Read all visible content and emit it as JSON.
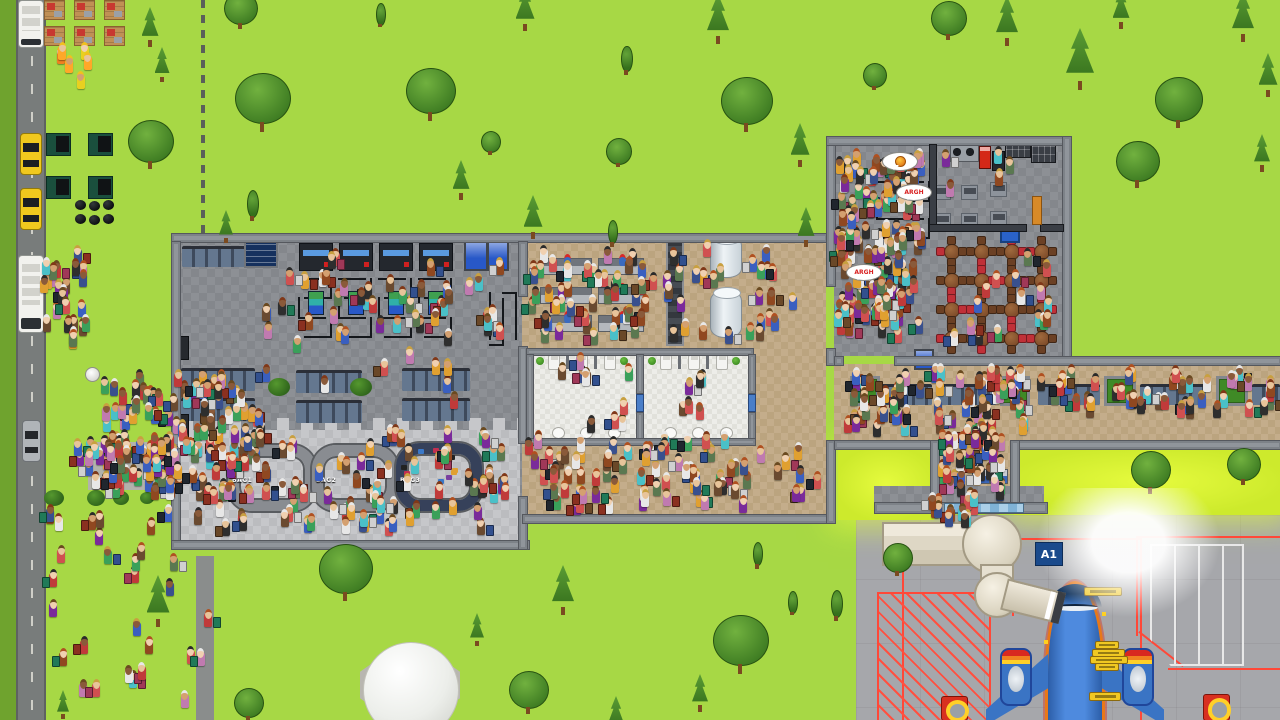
{
  "viewport": {
    "width": 1280,
    "height": 720
  },
  "labels": {
    "gate_sign": "A1",
    "carousels": [
      "BAG1",
      "BAG2",
      "BAG3"
    ],
    "speech_bubbles": [
      {
        "kind": "food-icon",
        "text": ""
      },
      {
        "kind": "text",
        "text": "ARGH"
      },
      {
        "kind": "text",
        "text": "ARGH"
      }
    ]
  },
  "palette": {
    "grass": "#a7d845",
    "grass_dark": "#6fa32e",
    "grass_lit": "#cdea2c",
    "road": "#787c7b",
    "tarmac": "#a6a7ab",
    "floor_dark": "#8d9095",
    "floor_light": "#c6c7ca",
    "floor_tan": "#c4ad8b",
    "floor_tile": "#ededE9",
    "wall": "#90959b",
    "carousel_gray": "#898c91",
    "carousel_navy": "#36415a",
    "plane_blue": "#4e8ade",
    "plane_trim_orange": "#e87818",
    "plane_trim_red": "#d83020",
    "gate_sign_bg": "#1a4a8c",
    "marking_red": "#ff4838",
    "jetbridge": "#e6e0d0",
    "taxi_yellow": "#f0c81e",
    "bubble_text_red": "#d82020"
  },
  "scene": {
    "floors": [
      [
        "grass-dark",
        0,
        0,
        16,
        720
      ],
      [
        "road",
        16,
        0,
        26,
        720
      ],
      [
        "service-road",
        196,
        556,
        18,
        164
      ],
      [
        "fence",
        201,
        0,
        4,
        237
      ],
      [
        "sidewalk",
        88,
        442,
        90,
        48
      ],
      [
        "tarmac",
        856,
        515,
        424,
        205
      ],
      [
        "bright",
        838,
        448,
        96,
        72
      ],
      [
        "bright",
        1014,
        448,
        266,
        67
      ],
      [
        "floor-dark",
        175,
        237,
        347,
        311
      ],
      [
        "floor-light",
        181,
        430,
        339,
        112
      ],
      [
        "scallop",
        181,
        418,
        339,
        12
      ],
      [
        "floor-tan",
        522,
        237,
        304,
        285
      ],
      [
        "floor-dark",
        834,
        144,
        228,
        212
      ],
      [
        "floor-tan",
        834,
        364,
        446,
        82
      ],
      [
        "floor-tan",
        938,
        446,
        72,
        60
      ],
      [
        "floor-dark",
        874,
        486,
        170,
        18
      ],
      [
        "floor-tile",
        530,
        354,
        106,
        84
      ],
      [
        "floor-tile",
        642,
        354,
        106,
        84
      ]
    ],
    "walls": [
      [
        171,
        233,
        655,
        8
      ],
      [
        171,
        241,
        8,
        204
      ],
      [
        171,
        478,
        8,
        70
      ],
      [
        171,
        540,
        357,
        8
      ],
      [
        518,
        241,
        8,
        54
      ],
      [
        518,
        346,
        8,
        96
      ],
      [
        518,
        496,
        8,
        52
      ],
      [
        522,
        514,
        312,
        8
      ],
      [
        826,
        440,
        8,
        82
      ],
      [
        826,
        136,
        8,
        149
      ],
      [
        826,
        348,
        8,
        16
      ],
      [
        826,
        136,
        244,
        8
      ],
      [
        1062,
        136,
        8,
        228
      ],
      [
        834,
        356,
        8,
        8
      ],
      [
        894,
        356,
        386,
        8
      ],
      [
        834,
        440,
        104,
        8
      ],
      [
        1010,
        440,
        270,
        8
      ],
      [
        930,
        440,
        8,
        66
      ],
      [
        1010,
        440,
        8,
        66
      ],
      [
        874,
        502,
        172,
        10
      ],
      [
        526,
        348,
        226,
        6
      ],
      [
        526,
        354,
        6,
        90
      ],
      [
        636,
        354,
        6,
        38
      ],
      [
        636,
        412,
        6,
        30
      ],
      [
        748,
        354,
        6,
        38
      ],
      [
        748,
        412,
        6,
        30
      ],
      [
        526,
        438,
        228,
        6
      ]
    ],
    "dark_walls": [
      [
        929,
        144,
        6,
        84
      ],
      [
        929,
        224,
        96,
        6
      ],
      [
        1040,
        224,
        22,
        6
      ]
    ],
    "glass_panels": [
      [
        944,
        503,
        78,
        8
      ]
    ],
    "security": {
      "lane_x": [
        298,
        338,
        378,
        418
      ],
      "scanner_y": 243,
      "queue_y": 268,
      "queue_h": 78
    },
    "extra_queues": {
      "exit_v": [
        482,
        292,
        40,
        54,
        3
      ],
      "foodcourt": [
        876,
        172,
        54,
        74,
        4
      ]
    },
    "bathrooms": {
      "room_x": [
        532,
        644
      ],
      "toilet_y": 355,
      "sink_y": 427
    },
    "diner_tables": {
      "x0": 938,
      "y0": 238,
      "cols": 4,
      "rows": 4,
      "dx": 30,
      "dy": 29
    },
    "furniture": [
      [
        "bench",
        182,
        246,
        64,
        18
      ],
      [
        "infoboard",
        244,
        236,
        30,
        28
      ],
      [
        "bench",
        181,
        368,
        74,
        20
      ],
      [
        "bench",
        296,
        370,
        66,
        20
      ],
      [
        "bench",
        402,
        368,
        68,
        20
      ],
      [
        "bench",
        181,
        398,
        74,
        20
      ],
      [
        "bench",
        296,
        400,
        66,
        20
      ],
      [
        "bench",
        402,
        398,
        68,
        20
      ],
      [
        "fridge",
        177,
        336,
        10,
        22
      ],
      [
        "fridge",
        177,
        414,
        10,
        22
      ],
      [
        "vendingblue",
        464,
        240,
        20,
        27
      ],
      [
        "vendingblue",
        487,
        240,
        18,
        27
      ],
      [
        "desk",
        540,
        258,
        50,
        15
      ],
      [
        "desk",
        598,
        258,
        44,
        15
      ],
      [
        "desk",
        540,
        287,
        50,
        15
      ],
      [
        "desk",
        598,
        287,
        44,
        15
      ],
      [
        "desk",
        540,
        315,
        50,
        15
      ],
      [
        "desk",
        598,
        315,
        44,
        15
      ],
      [
        "conveyor",
        666,
        238,
        14,
        104
      ],
      [
        "cylinder",
        710,
        236,
        30,
        40
      ],
      [
        "cylinder",
        710,
        290,
        30,
        46
      ],
      [
        "stove",
        950,
        143,
        27,
        17
      ],
      [
        "vendingred",
        979,
        146,
        10,
        21
      ],
      [
        "fridge",
        992,
        151,
        11,
        18
      ],
      [
        "counterdark",
        1005,
        140,
        24,
        16
      ],
      [
        "counterdark",
        1031,
        145,
        23,
        16
      ],
      [
        "preptable",
        934,
        185,
        15,
        13
      ],
      [
        "preptable",
        961,
        185,
        15,
        13
      ],
      [
        "preptable",
        990,
        182,
        15,
        13
      ],
      [
        "preptable",
        934,
        213,
        15,
        13
      ],
      [
        "preptable",
        961,
        213,
        15,
        13
      ],
      [
        "preptable",
        990,
        211,
        15,
        13
      ],
      [
        "crate",
        1000,
        224,
        16,
        15
      ],
      [
        "dooror",
        1032,
        196,
        8,
        27
      ],
      [
        "doorblue",
        636,
        394,
        6,
        16
      ],
      [
        "doorblue",
        748,
        394,
        6,
        16
      ],
      [
        "gatedesk",
        972,
        469,
        16,
        13
      ],
      [
        "gatedesk",
        990,
        469,
        16,
        13
      ],
      [
        "vendingblue",
        914,
        349,
        16,
        17
      ],
      [
        "planter",
        850,
        376,
        24,
        24
      ],
      [
        "bench",
        876,
        384,
        56,
        18
      ],
      [
        "bench",
        938,
        384,
        58,
        18
      ],
      [
        "planter",
        1000,
        376,
        24,
        24
      ],
      [
        "bench",
        1038,
        384,
        62,
        18
      ],
      [
        "planter",
        1104,
        376,
        26,
        24
      ],
      [
        "bench",
        1140,
        384,
        66,
        18
      ],
      [
        "planter",
        1216,
        376,
        26,
        24
      ],
      [
        "bench",
        1252,
        384,
        28,
        18
      ],
      [
        "tag",
        1084,
        587,
        36,
        7
      ],
      [
        "tag",
        1095,
        641,
        22,
        6
      ],
      [
        "tag",
        1092,
        649,
        31,
        6
      ],
      [
        "tag",
        1090,
        656,
        36,
        6
      ],
      [
        "tag",
        1095,
        663,
        22,
        6
      ],
      [
        "tag",
        1089,
        692,
        30,
        7
      ],
      [
        "fuelpit",
        941,
        696,
        25,
        23
      ],
      [
        "fuelpit",
        1203,
        694,
        25,
        25
      ],
      [
        "pallet",
        44,
        0,
        19,
        18
      ],
      [
        "pallet",
        74,
        0,
        19,
        18
      ],
      [
        "pallet",
        104,
        0,
        19,
        18
      ],
      [
        "pallet",
        44,
        26,
        19,
        18
      ],
      [
        "pallet",
        74,
        26,
        19,
        18
      ],
      [
        "pallet",
        104,
        26,
        19,
        18
      ],
      [
        "dumpster",
        46,
        133,
        23,
        21
      ],
      [
        "dumpster",
        88,
        133,
        23,
        21
      ],
      [
        "dumpster",
        46,
        176,
        23,
        21
      ],
      [
        "dumpster",
        88,
        176,
        23,
        21
      ],
      [
        "trashbag",
        75,
        200,
        11,
        10
      ],
      [
        "trashbag",
        89,
        201,
        11,
        10
      ],
      [
        "trashbag",
        103,
        200,
        11,
        10
      ],
      [
        "trashbag",
        75,
        214,
        11,
        10
      ],
      [
        "trashbag",
        89,
        215,
        11,
        10
      ],
      [
        "trashbag",
        103,
        214,
        11,
        10
      ],
      [
        "hedge",
        97,
        447,
        44,
        11
      ],
      [
        "hedge",
        152,
        447,
        16,
        11
      ],
      [
        "bush",
        44,
        490,
        20,
        16
      ],
      [
        "bush",
        87,
        490,
        18,
        16
      ],
      [
        "bush",
        113,
        491,
        16,
        14
      ],
      [
        "bush",
        140,
        492,
        14,
        12
      ],
      [
        "bush",
        268,
        378,
        22,
        18
      ],
      [
        "bush",
        350,
        378,
        22,
        18
      ],
      [
        "bus",
        18,
        0,
        24,
        46
      ],
      [
        "taxi",
        20,
        133,
        20,
        40
      ],
      [
        "taxi",
        20,
        188,
        20,
        40
      ],
      [
        "bus",
        18,
        255,
        24,
        76
      ],
      [
        "car",
        22,
        420,
        17,
        40
      ],
      [
        "lamp",
        85,
        367,
        13,
        13
      ]
    ],
    "trees": [
      [
        262,
        100,
        "R",
        54
      ],
      [
        430,
        92,
        "R",
        48
      ],
      [
        618,
        150,
        "R",
        24
      ],
      [
        746,
        102,
        "R",
        50
      ],
      [
        874,
        74,
        "R",
        22
      ],
      [
        948,
        18,
        "R",
        34
      ],
      [
        718,
        16,
        "C",
        44
      ],
      [
        626,
        57,
        "Y",
        22
      ],
      [
        525,
        6,
        "C",
        38
      ],
      [
        461,
        177,
        "C",
        34
      ],
      [
        490,
        140,
        "R",
        18
      ],
      [
        533,
        214,
        "C",
        38
      ],
      [
        1007,
        18,
        "C",
        44
      ],
      [
        1080,
        56,
        "C",
        56
      ],
      [
        1121,
        6,
        "C",
        34
      ],
      [
        1178,
        100,
        "R",
        46
      ],
      [
        1243,
        14,
        "C",
        44
      ],
      [
        1268,
        72,
        "C",
        38
      ],
      [
        1137,
        162,
        "R",
        42
      ],
      [
        612,
        230,
        "Y",
        20
      ],
      [
        150,
        24,
        "C",
        34
      ],
      [
        162,
        62,
        "C",
        30
      ],
      [
        150,
        142,
        "R",
        44
      ],
      [
        240,
        8,
        "R",
        32
      ],
      [
        252,
        202,
        "Y",
        24
      ],
      [
        226,
        224,
        "C",
        28
      ],
      [
        800,
        142,
        "C",
        38
      ],
      [
        806,
        224,
        "C",
        34
      ],
      [
        1262,
        150,
        "C",
        32
      ],
      [
        380,
        12,
        "Y",
        18
      ],
      [
        345,
        570,
        "R",
        52
      ],
      [
        563,
        587,
        "C",
        44
      ],
      [
        477,
        627,
        "C",
        28
      ],
      [
        528,
        690,
        "R",
        38
      ],
      [
        616,
        712,
        "C",
        32
      ],
      [
        740,
        642,
        "R",
        54
      ],
      [
        700,
        690,
        "C",
        32
      ],
      [
        836,
        602,
        "Y",
        24
      ],
      [
        757,
        552,
        "Y",
        20
      ],
      [
        792,
        600,
        "Y",
        18
      ],
      [
        158,
        598,
        "C",
        46
      ],
      [
        248,
        702,
        "R",
        28
      ],
      [
        1150,
        470,
        "R",
        38
      ],
      [
        1243,
        464,
        "R",
        32
      ],
      [
        897,
        557,
        "R",
        28
      ],
      [
        63,
        702,
        "C",
        24
      ]
    ],
    "crowds": [
      {
        "name": "bus-stop-crowd",
        "x": 100,
        "y": 372,
        "w": 165,
        "h": 132,
        "n": 130,
        "seed": 11
      },
      {
        "name": "path-walkers",
        "x": 70,
        "y": 436,
        "w": 115,
        "h": 58,
        "n": 32,
        "seed": 12
      },
      {
        "name": "grass-walkers",
        "x": 25,
        "y": 495,
        "w": 195,
        "h": 220,
        "n": 30,
        "seed": 13
      },
      {
        "name": "bus-arrivals",
        "x": 40,
        "y": 248,
        "w": 58,
        "h": 88,
        "n": 22,
        "seed": 14
      },
      {
        "name": "terminal-scatter",
        "x": 190,
        "y": 268,
        "w": 320,
        "h": 156,
        "n": 30,
        "seed": 15
      },
      {
        "name": "security-queue",
        "x": 298,
        "y": 250,
        "w": 212,
        "h": 96,
        "n": 22,
        "seed": 16
      },
      {
        "name": "baggage-claim-crowd",
        "x": 188,
        "y": 428,
        "w": 328,
        "h": 112,
        "n": 95,
        "seed": 17
      },
      {
        "name": "checkin-crowd",
        "x": 526,
        "y": 246,
        "w": 165,
        "h": 100,
        "n": 55,
        "seed": 18
      },
      {
        "name": "checkin-scatter",
        "x": 692,
        "y": 240,
        "w": 130,
        "h": 108,
        "n": 20,
        "seed": 19
      },
      {
        "name": "bathroom-users",
        "x": 536,
        "y": 356,
        "w": 206,
        "h": 78,
        "n": 16,
        "seed": 20
      },
      {
        "name": "hallway-crowd",
        "x": 524,
        "y": 432,
        "w": 304,
        "h": 84,
        "n": 78,
        "seed": 21
      },
      {
        "name": "foodcourt-queue",
        "x": 834,
        "y": 150,
        "w": 92,
        "h": 196,
        "n": 150,
        "seed": 22
      },
      {
        "name": "foodcourt-staff",
        "x": 935,
        "y": 150,
        "w": 80,
        "h": 60,
        "n": 5,
        "seed": 23
      },
      {
        "name": "foodcourt-diners",
        "x": 938,
        "y": 238,
        "w": 118,
        "h": 110,
        "n": 16,
        "seed": 24
      },
      {
        "name": "corridor-crowd-west",
        "x": 836,
        "y": 366,
        "w": 196,
        "h": 72,
        "n": 72,
        "seed": 25
      },
      {
        "name": "corridor-crowd-east",
        "x": 1036,
        "y": 368,
        "w": 240,
        "h": 52,
        "n": 45,
        "seed": 26
      },
      {
        "name": "boarding-queue",
        "x": 938,
        "y": 426,
        "w": 70,
        "h": 76,
        "n": 45,
        "seed": 27
      },
      {
        "name": "jetbridge-boarders",
        "x": 928,
        "y": 490,
        "w": 52,
        "h": 40,
        "n": 14,
        "seed": 28
      },
      {
        "name": "construction-workers",
        "x": 46,
        "y": 44,
        "w": 58,
        "h": 56,
        "n": 6,
        "seed": 29,
        "pal": "worker"
      },
      {
        "name": "road-walkers",
        "x": 50,
        "y": 325,
        "w": 30,
        "h": 25,
        "n": 3,
        "seed": 30
      }
    ]
  }
}
